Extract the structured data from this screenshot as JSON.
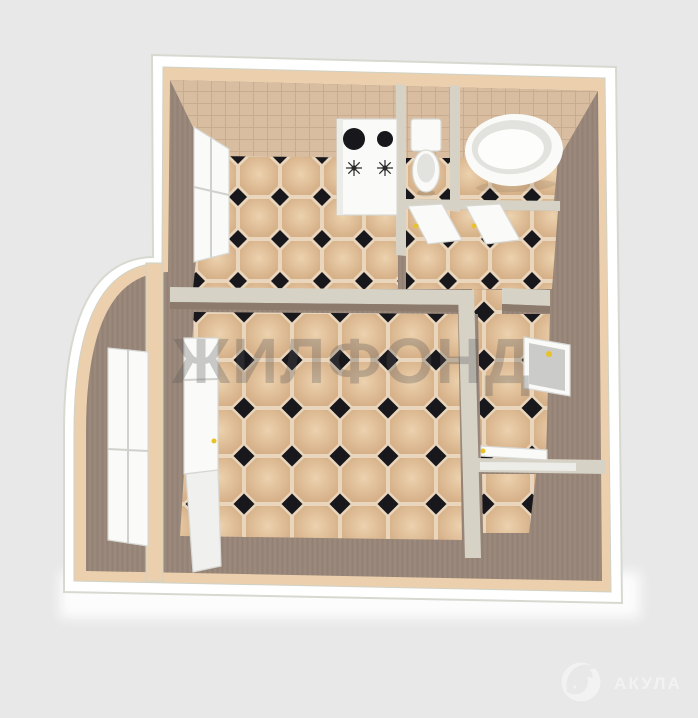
{
  "watermark": {
    "text": "ЖИЛФОНД"
  },
  "logo": {
    "text": "АКУЛА",
    "icon": "shark-icon"
  },
  "scene": {
    "type": "3d-floor-plan-render",
    "objects": [
      "kitchen-stove",
      "toilet",
      "bathtub",
      "kitchen-window",
      "balcony-bay-window",
      "balcony-door",
      "wc-door",
      "bathroom-door",
      "entrance-door",
      "corridor-door",
      "tiled-floor",
      "balcony"
    ]
  },
  "colors": {
    "background": "#e8e8e8",
    "plan_outline": "#ffffff",
    "outline_edge": "#d7d9d1",
    "outer_wall_top": "#ecd0ae",
    "partition_top": "#d6d2c6",
    "wall_face": "#9b897b",
    "wall_face_dark": "#8c7b6d",
    "backsplash": "#d8bda0",
    "backsplash_grid": "#c9ac8d",
    "tile_grout": "#e9d6bc",
    "tile_light": "#ecd2ae",
    "tile_mid": "#dcb992",
    "tile_dark": "#cfa87f",
    "tile_diamond": "#17171c",
    "fixture_white": "#fafaf8",
    "fixture_shade": "#e2e2de",
    "door_leaf": "#cbcbc9",
    "handle_yellow": "#e8c22a",
    "watermark": "#58585a",
    "logo": "#f2f2f2"
  }
}
